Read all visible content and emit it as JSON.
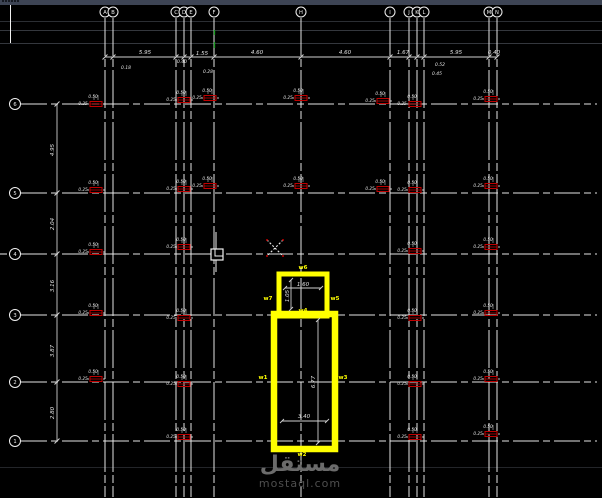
{
  "window": {
    "topbar_color": "#3d4454"
  },
  "colors": {
    "background": "#000000",
    "grid": "#f0f0f0",
    "dim_line": "#cfcfcf",
    "dim_text": "#e0e0e0",
    "column_red": "#c00000",
    "wall_yellow": "#ffff00",
    "green_mark": "#1d9e23",
    "separator": "#34373d",
    "separator_bottom": "#232529",
    "watermark_gray": "#6b6b6b"
  },
  "grid": {
    "columns": [
      {
        "label": "A",
        "x": 105
      },
      {
        "label": "B",
        "x": 113
      },
      {
        "label": "C",
        "x": 176
      },
      {
        "label": "D",
        "x": 184
      },
      {
        "label": "E",
        "x": 191
      },
      {
        "label": "F",
        "x": 214
      },
      {
        "label": "H",
        "x": 301
      },
      {
        "label": "I",
        "x": 390
      },
      {
        "label": "J",
        "x": 409
      },
      {
        "label": "K",
        "x": 417
      },
      {
        "label": "L",
        "x": 424
      },
      {
        "label": "M",
        "x": 489
      },
      {
        "label": "N",
        "x": 497
      }
    ],
    "rows": [
      {
        "label": "6",
        "y": 104
      },
      {
        "label": "5",
        "y": 193
      },
      {
        "label": "4",
        "y": 254
      },
      {
        "label": "3",
        "y": 315
      },
      {
        "label": "2",
        "y": 382
      },
      {
        "label": "1",
        "y": 441
      }
    ],
    "bubble_row_y": 12,
    "bubble_col_x": 15,
    "v_y1": 18,
    "v_y2": 497,
    "h_x1": 21,
    "h_x2": 597
  },
  "dimensions": {
    "top_line": {
      "y": 57,
      "x1": 105,
      "x2": 497
    },
    "top_texts": [
      {
        "t": "5.95",
        "x": 145,
        "y": 54
      },
      {
        "t": "1.55",
        "x": 202,
        "y": 55
      },
      {
        "t": "4.60",
        "x": 257,
        "y": 54
      },
      {
        "t": "4.60",
        "x": 345,
        "y": 54
      },
      {
        "t": "1.67",
        "x": 403,
        "y": 54
      },
      {
        "t": "5.95",
        "x": 456,
        "y": 54
      },
      {
        "t": "0.40",
        "x": 494,
        "y": 54
      }
    ],
    "top_sub_texts": [
      {
        "t": "0.18",
        "x": 126,
        "y": 69
      },
      {
        "t": "0.40",
        "x": 182,
        "y": 63
      },
      {
        "t": "0.28",
        "x": 208,
        "y": 73
      },
      {
        "t": "0.52",
        "x": 440,
        "y": 66
      },
      {
        "t": "0.45",
        "x": 437,
        "y": 75
      }
    ],
    "left_line": {
      "x": 57,
      "y1": 104,
      "y2": 441
    },
    "left_texts": [
      {
        "t": "4.95",
        "x": 54,
        "y": 150
      },
      {
        "t": "2.04",
        "x": 54,
        "y": 224
      },
      {
        "t": "3.16",
        "x": 54,
        "y": 286
      },
      {
        "t": "3.87",
        "x": 54,
        "y": 351
      },
      {
        "t": "2.80",
        "x": 54,
        "y": 413
      }
    ]
  },
  "columns_symbols": {
    "texts": [
      "0.50",
      "0.25"
    ],
    "positions": [
      {
        "x": 96,
        "y": 104
      },
      {
        "x": 184,
        "y": 100
      },
      {
        "x": 210,
        "y": 98
      },
      {
        "x": 301,
        "y": 98
      },
      {
        "x": 383,
        "y": 101
      },
      {
        "x": 415,
        "y": 104
      },
      {
        "x": 491,
        "y": 99
      },
      {
        "x": 96,
        "y": 190
      },
      {
        "x": 184,
        "y": 189
      },
      {
        "x": 210,
        "y": 186
      },
      {
        "x": 301,
        "y": 186
      },
      {
        "x": 383,
        "y": 189
      },
      {
        "x": 415,
        "y": 190
      },
      {
        "x": 491,
        "y": 186
      },
      {
        "x": 96,
        "y": 252
      },
      {
        "x": 184,
        "y": 247
      },
      {
        "x": 415,
        "y": 251
      },
      {
        "x": 491,
        "y": 247
      },
      {
        "x": 96,
        "y": 313
      },
      {
        "x": 184,
        "y": 318
      },
      {
        "x": 415,
        "y": 318
      },
      {
        "x": 491,
        "y": 313
      },
      {
        "x": 96,
        "y": 379
      },
      {
        "x": 184,
        "y": 384
      },
      {
        "x": 415,
        "y": 384
      },
      {
        "x": 491,
        "y": 379
      },
      {
        "x": 184,
        "y": 437
      },
      {
        "x": 415,
        "y": 437
      },
      {
        "x": 491,
        "y": 434
      }
    ]
  },
  "wall": {
    "small_rect": {
      "x": 279,
      "y": 274,
      "w": 48,
      "h": 42,
      "sw": 5
    },
    "large_rect": {
      "x": 274,
      "y": 314,
      "w": 61,
      "h": 135,
      "sw": 6.5
    },
    "labels": [
      {
        "t": "w6",
        "x": 303,
        "y": 269
      },
      {
        "t": "w7",
        "x": 268,
        "y": 300
      },
      {
        "t": "w5",
        "x": 335,
        "y": 300
      },
      {
        "t": "w4",
        "x": 303,
        "y": 312
      },
      {
        "t": "w1",
        "x": 263,
        "y": 379
      },
      {
        "t": "w3",
        "x": 343,
        "y": 379
      },
      {
        "t": "w2",
        "x": 302,
        "y": 456
      }
    ],
    "dim_lines": [
      {
        "x1": 285,
        "y1": 288,
        "x2": 321,
        "y2": 288
      },
      {
        "x1": 291,
        "y1": 280,
        "x2": 291,
        "y2": 309
      },
      {
        "x1": 318,
        "y1": 320,
        "x2": 318,
        "y2": 443
      },
      {
        "x1": 282,
        "y1": 421,
        "x2": 327,
        "y2": 421
      }
    ],
    "dim_texts": [
      {
        "t": "1.60",
        "x": 303,
        "y": 286,
        "rot": 0
      },
      {
        "t": "1.05",
        "x": 289,
        "y": 296,
        "rot": 1
      },
      {
        "t": "6.77",
        "x": 315,
        "y": 382,
        "rot": 1
      },
      {
        "t": "3.40",
        "x": 304,
        "y": 418,
        "rot": 0
      }
    ]
  },
  "markers": {
    "pickbox_outer": {
      "x": 211,
      "y": 249,
      "w": 12,
      "h": 11
    },
    "pickbox_inner": {
      "x": 215,
      "y": 249,
      "w": 8,
      "h": 7
    },
    "pickbox_vline": {
      "x": 216,
      "y1": 232,
      "y2": 272
    },
    "x_mark": {
      "x1": 267,
      "y1": 240,
      "x2": 283,
      "y2": 256
    },
    "green_dashes": [
      {
        "x": 214.5,
        "y1": 30,
        "y2": 35
      },
      {
        "x": 214.5,
        "y1": 42,
        "y2": 48
      }
    ],
    "left_vline": {
      "x": 10.5,
      "y1": 5,
      "y2": 43
    },
    "left_tick": {
      "y": 254,
      "x1": 0,
      "x2": 7
    },
    "separators": [
      {
        "y": 21.5,
        "c": "#2b2e33"
      },
      {
        "y": 30.5,
        "c": "#34373d"
      },
      {
        "y": 43.5,
        "c": "#34373d"
      },
      {
        "y": 467.5,
        "c": "#232529"
      }
    ]
  },
  "watermark": {
    "arabic": "مستقل",
    "domain": "mostaql.com"
  }
}
